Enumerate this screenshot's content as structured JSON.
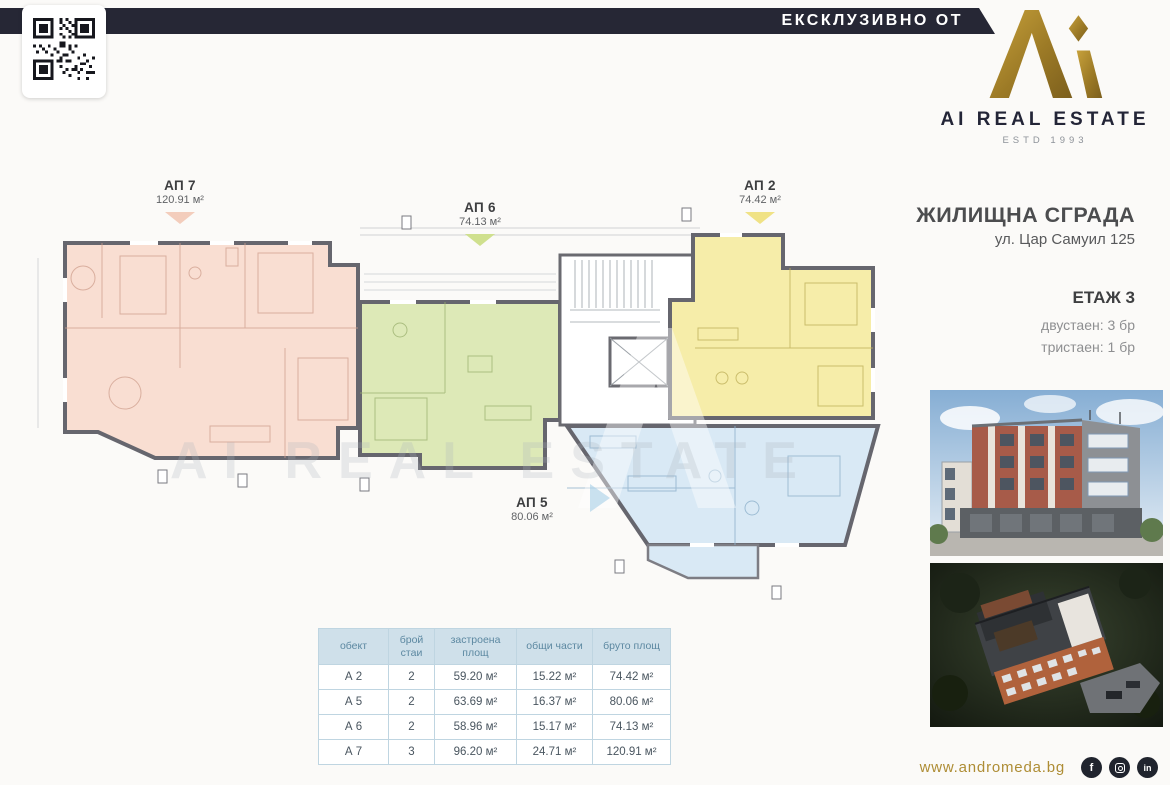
{
  "banner": {
    "label": "ЕКСКЛУЗИВНО ОТ"
  },
  "brand": {
    "name": "AI REAL ESTATE",
    "estd": "ESTD 1993"
  },
  "project": {
    "title": "ЖИЛИЩНА СГРАДА",
    "address": "ул. Цар Самуил 125",
    "floor": "ЕТАЖ 3",
    "mix": [
      "двустаен: 3 бр",
      "тристаен: 1 бр"
    ]
  },
  "plan": {
    "watermark": "AI REAL ESTATE",
    "apartments": [
      {
        "label": "АП 7",
        "area": "120.91 м²",
        "color": "#f9ded2"
      },
      {
        "label": "АП 6",
        "area": "74.13 м²",
        "color": "#dde9b7"
      },
      {
        "label": "АП 2",
        "area": "74.42 м²",
        "color": "#f6eda9"
      },
      {
        "label": "АП 5",
        "area": "80.06 м²",
        "color": "#d9e9f5"
      }
    ]
  },
  "table": {
    "headers": [
      "обект",
      "брой стаи",
      "застроена площ",
      "общи части",
      "бруто площ"
    ],
    "rows": [
      [
        "А 2",
        "2",
        "59.20 м²",
        "15.22 м²",
        "74.42 м²"
      ],
      [
        "А 5",
        "2",
        "63.69 м²",
        "16.37 м²",
        "80.06 м²"
      ],
      [
        "А 6",
        "2",
        "58.96 м²",
        "15.17 м²",
        "74.13 м²"
      ],
      [
        "А 7",
        "3",
        "96.20 м²",
        "24.71 м²",
        "120.91 м²"
      ]
    ]
  },
  "footer": {
    "website": "www.andromeda.bg",
    "social_icons": [
      "facebook-icon",
      "instagram-icon",
      "linkedin-icon"
    ]
  },
  "colors": {
    "banner_navy": "#262735",
    "brand_gold": "#a8852f",
    "table_header_bg": "#cfe0ea",
    "table_header_text": "#5c88a1",
    "wall_gray": "#66666e"
  }
}
